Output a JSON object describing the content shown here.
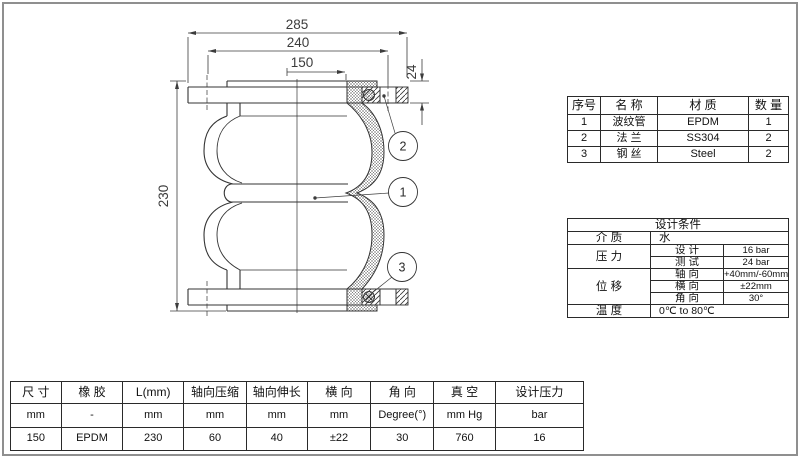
{
  "drawing": {
    "dim_overall": "285",
    "dim_bolt_circle": "240",
    "dim_bore": "150",
    "dim_flange_thickness": "24",
    "dim_height": "230",
    "callout_1": "1",
    "callout_2": "2",
    "callout_3": "3"
  },
  "parts_table": {
    "headers": {
      "no": "序号",
      "name": "名 称",
      "material": "材 质",
      "qty": "数 量"
    },
    "rows": [
      {
        "no": "1",
        "name": "波纹管",
        "material": "EPDM",
        "qty": "1"
      },
      {
        "no": "2",
        "name": "法 兰",
        "material": "SS304",
        "qty": "2"
      },
      {
        "no": "3",
        "name": "钢 丝",
        "material": "Steel",
        "qty": "2"
      }
    ]
  },
  "design_table": {
    "title": "设计条件",
    "medium_label": "介 质",
    "medium_value": "水",
    "pressure_label": "压 力",
    "pressure_design_label": "设 计",
    "pressure_design_value": "16 bar",
    "pressure_test_label": "测 试",
    "pressure_test_value": "24 bar",
    "disp_label": "位 移",
    "disp_axial_label": "轴 向",
    "disp_axial_value": "+40mm/-60mm",
    "disp_lateral_label": "横 向",
    "disp_lateral_value": "±22mm",
    "disp_angular_label": "角 向",
    "disp_angular_value": "30°",
    "temp_label": "温 度",
    "temp_value": "0℃ to 80℃"
  },
  "spec_table": {
    "columns": [
      {
        "header": "尺 寸",
        "unit": "mm",
        "value": "150"
      },
      {
        "header": "橡 胶",
        "unit": "-",
        "value": "EPDM"
      },
      {
        "header": "L(mm)",
        "unit": "mm",
        "value": "230"
      },
      {
        "header": "轴向压缩",
        "unit": "mm",
        "value": "60"
      },
      {
        "header": "轴向伸长",
        "unit": "mm",
        "value": "40"
      },
      {
        "header": "横 向",
        "unit": "mm",
        "value": "±22"
      },
      {
        "header": "角 向",
        "unit": "Degree(°)",
        "value": "30"
      },
      {
        "header": "真 空",
        "unit": "mm Hg",
        "value": "760"
      },
      {
        "header": "设计压力",
        "unit": "bar",
        "value": "16"
      }
    ]
  },
  "colors": {
    "line": "#333333",
    "dim": "#3c3c3c",
    "page_border": "#8f8f8f"
  }
}
